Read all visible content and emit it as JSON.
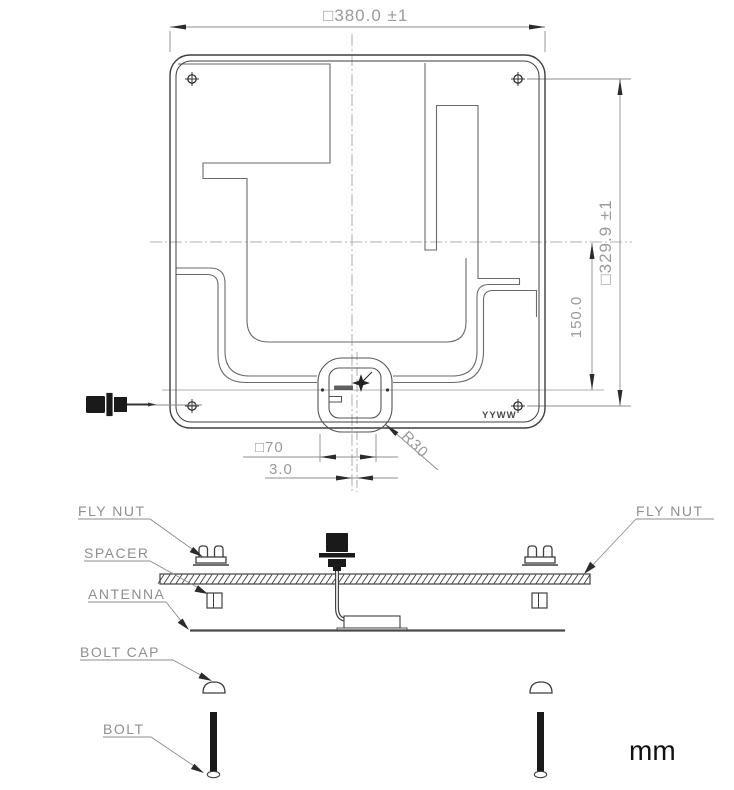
{
  "drawing": {
    "units": "mm",
    "top_view": {
      "width_dim": "□380.0  ±1",
      "height_dim": "□329.9  ±1",
      "feed_height_dim": "150.0",
      "connector_square_dim": "□70",
      "offset_dim": "3.0",
      "corner_radius_dim": "R30",
      "date_code": "YYWW"
    },
    "exploded_view": {
      "fly_nut_left_label": "FLY NUT",
      "fly_nut_right_label": "FLY NUT",
      "spacer_label": "SPACER",
      "antenna_label": "ANTENNA",
      "bolt_cap_label": "BOLT CAP",
      "bolt_label": "BOLT"
    },
    "colors": {
      "line_dark": "#3f3f3f",
      "dim_gray": "#8c8c8c",
      "text_gray": "#9a9a9a",
      "ink_black": "#111111"
    }
  }
}
